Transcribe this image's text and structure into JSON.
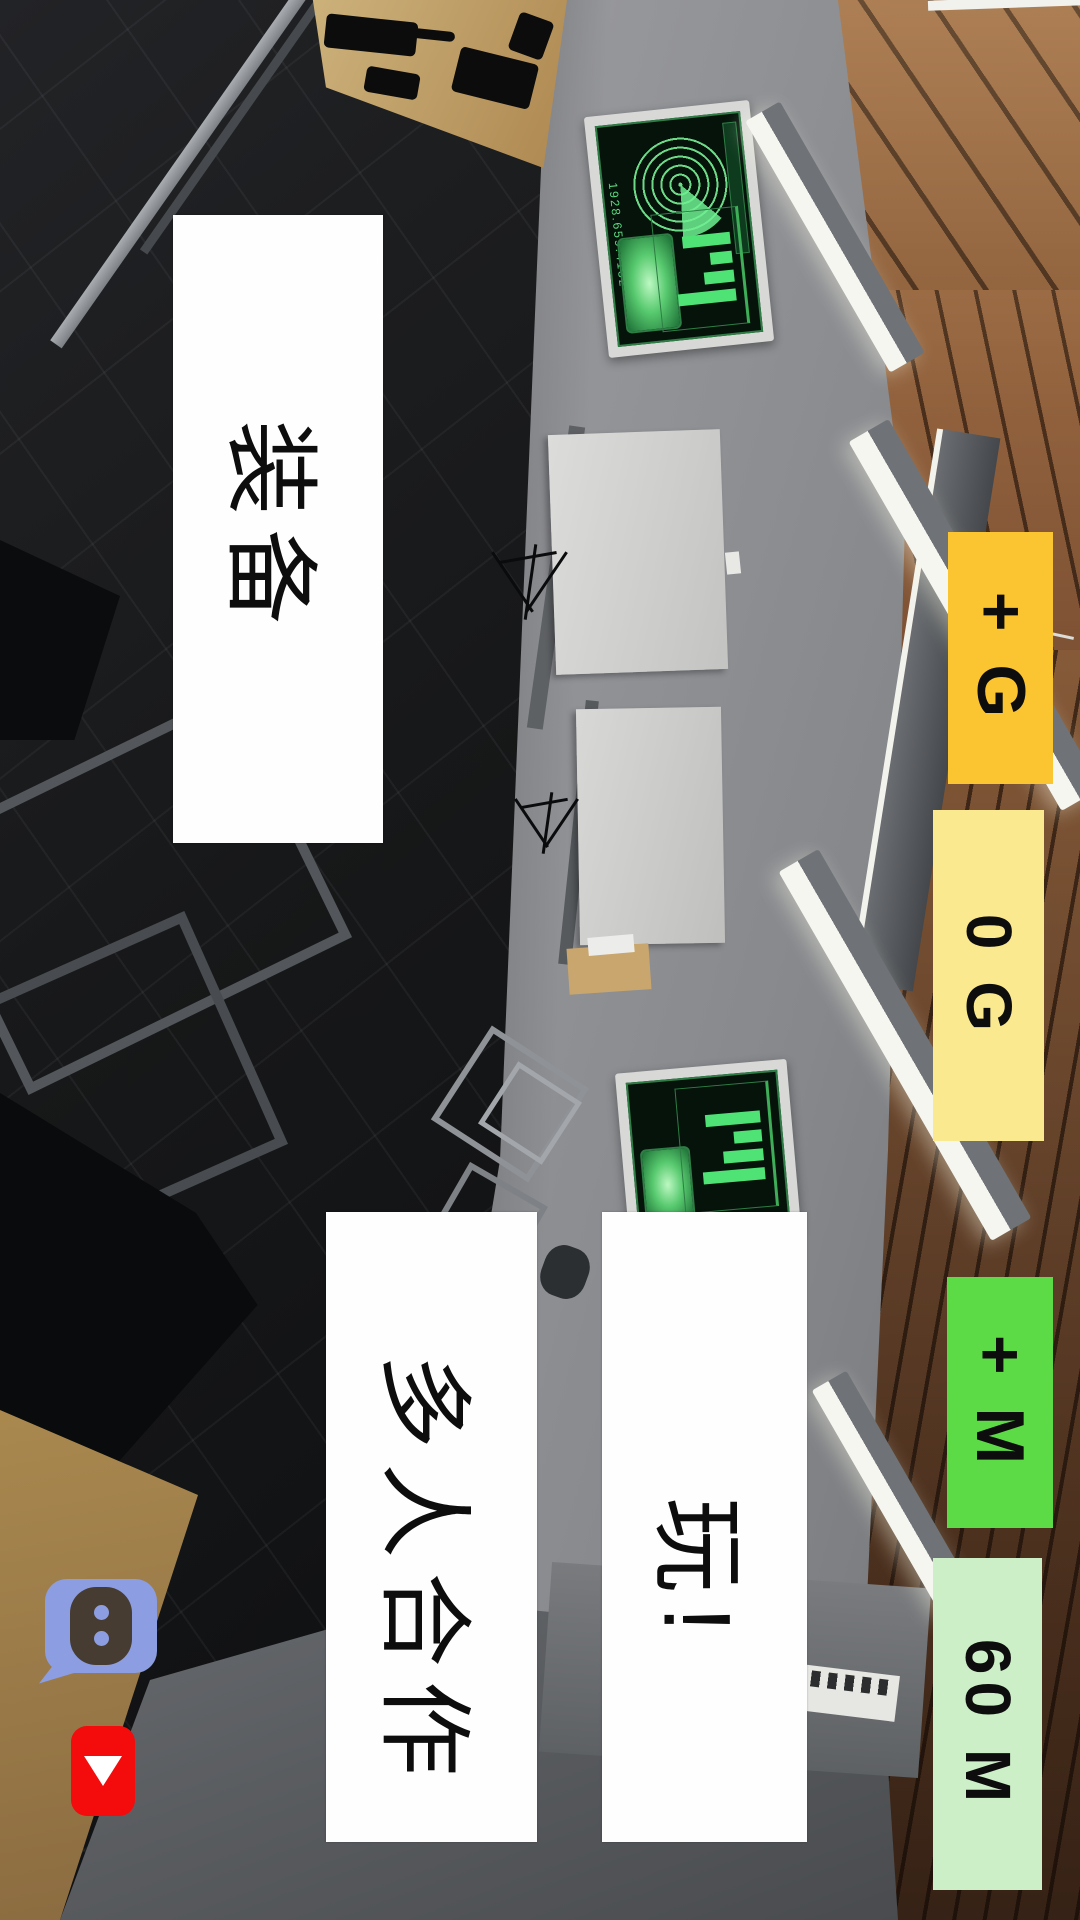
{
  "hud": {
    "gold_add": {
      "label": "+ G",
      "bg": "#fbc531"
    },
    "gold_count": {
      "label": "0 G",
      "bg": "#fae98e"
    },
    "money_add": {
      "label": "+ M",
      "bg": "#5cdb47"
    },
    "money_count": {
      "label": "60 M",
      "bg": "#cdefc8"
    }
  },
  "menu": {
    "equipment": {
      "label": "装备"
    },
    "multiplayer": {
      "label": "多人合作"
    },
    "play": {
      "label": "玩!"
    }
  },
  "social": {
    "discord": {
      "icon": "discord-speech-bubble-icon",
      "bg": "#8c9ee1",
      "eye_color": "#8c9ee1"
    },
    "youtube": {
      "icon": "youtube-play-icon",
      "bg": "#f40b0b"
    }
  },
  "scene": {
    "radar_code": "1928.659.4132",
    "screen_green": "#4ee374",
    "wood_brown": "#7c5234",
    "wall_dark": "#141518"
  }
}
